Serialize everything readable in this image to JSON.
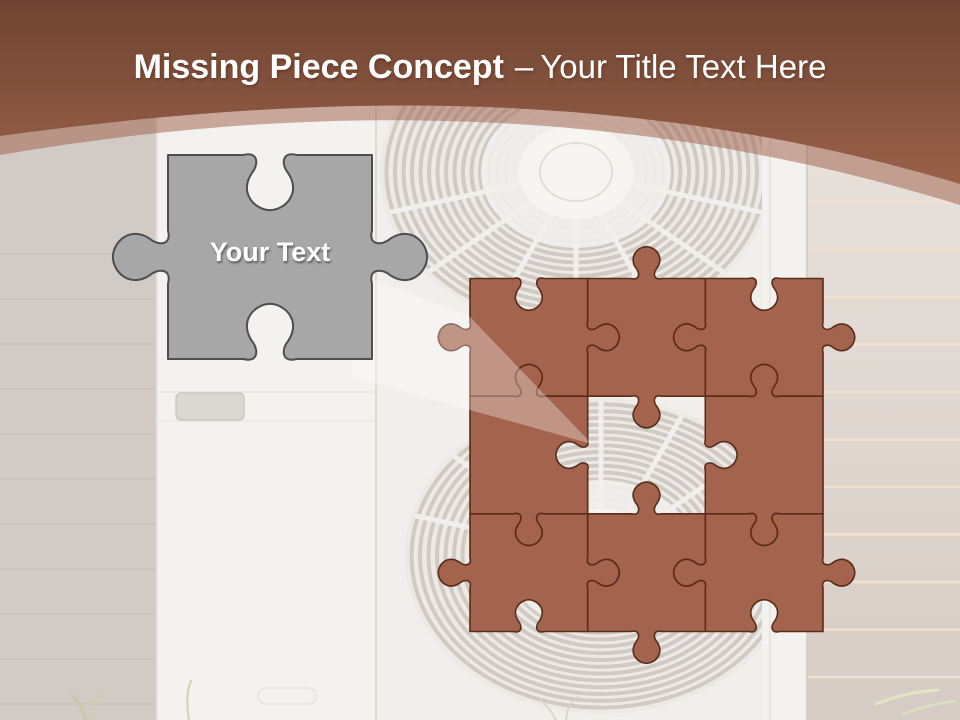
{
  "title": {
    "bold": "Missing Piece Concept",
    "separator": "–",
    "regular": "Your Title Text Here"
  },
  "header": {
    "top_color": "#6e4432",
    "bottom_color": "#9a6149",
    "band_color": "rgba(164,104,84,0.55)",
    "text_color": "#ffffff"
  },
  "gray_piece": {
    "label": "Your Text",
    "x": 168,
    "y": 155,
    "size": 204,
    "fill": "#a7a7a7",
    "stroke": "#4e4e4e",
    "edges": [
      "socket",
      "tab",
      "socket",
      "tab"
    ]
  },
  "puzzle": {
    "x": 470,
    "y": 278.5,
    "cell": 117.67,
    "fill": "#a4634c",
    "stroke": "#5a2c1a",
    "missing": {
      "row": 1,
      "col": 1
    },
    "pieces": [
      {
        "name": "puzzle-piece-top-left",
        "row": 0,
        "col": 0,
        "edges": [
          "socket",
          "tab",
          "socket",
          "tab"
        ]
      },
      {
        "name": "puzzle-piece-top-middle",
        "row": 0,
        "col": 1,
        "edges": [
          "tab",
          "socket",
          "tab",
          "socket"
        ]
      },
      {
        "name": "puzzle-piece-top-right",
        "row": 0,
        "col": 2,
        "edges": [
          "socket",
          "tab",
          "socket",
          "tab"
        ]
      },
      {
        "name": "puzzle-piece-middle-left",
        "row": 1,
        "col": 0,
        "edges": [
          "tab",
          "socket",
          "tab",
          "flat"
        ]
      },
      {
        "name": "puzzle-piece-middle-right",
        "row": 1,
        "col": 2,
        "edges": [
          "tab",
          "flat",
          "tab",
          "socket"
        ]
      },
      {
        "name": "puzzle-piece-bottom-left",
        "row": 2,
        "col": 0,
        "edges": [
          "socket",
          "tab",
          "socket",
          "tab"
        ]
      },
      {
        "name": "puzzle-piece-bottom-middle",
        "row": 2,
        "col": 1,
        "edges": [
          "tab",
          "socket",
          "tab",
          "socket"
        ]
      },
      {
        "name": "puzzle-piece-bottom-right",
        "row": 2,
        "col": 2,
        "edges": [
          "socket",
          "tab",
          "socket",
          "tab"
        ]
      }
    ]
  },
  "beam": {
    "points": [
      [
        352,
        271
      ],
      [
        470,
        317
      ],
      [
        592,
        444
      ],
      [
        352,
        377
      ]
    ],
    "fill": "rgba(255,255,255,0.32)"
  }
}
